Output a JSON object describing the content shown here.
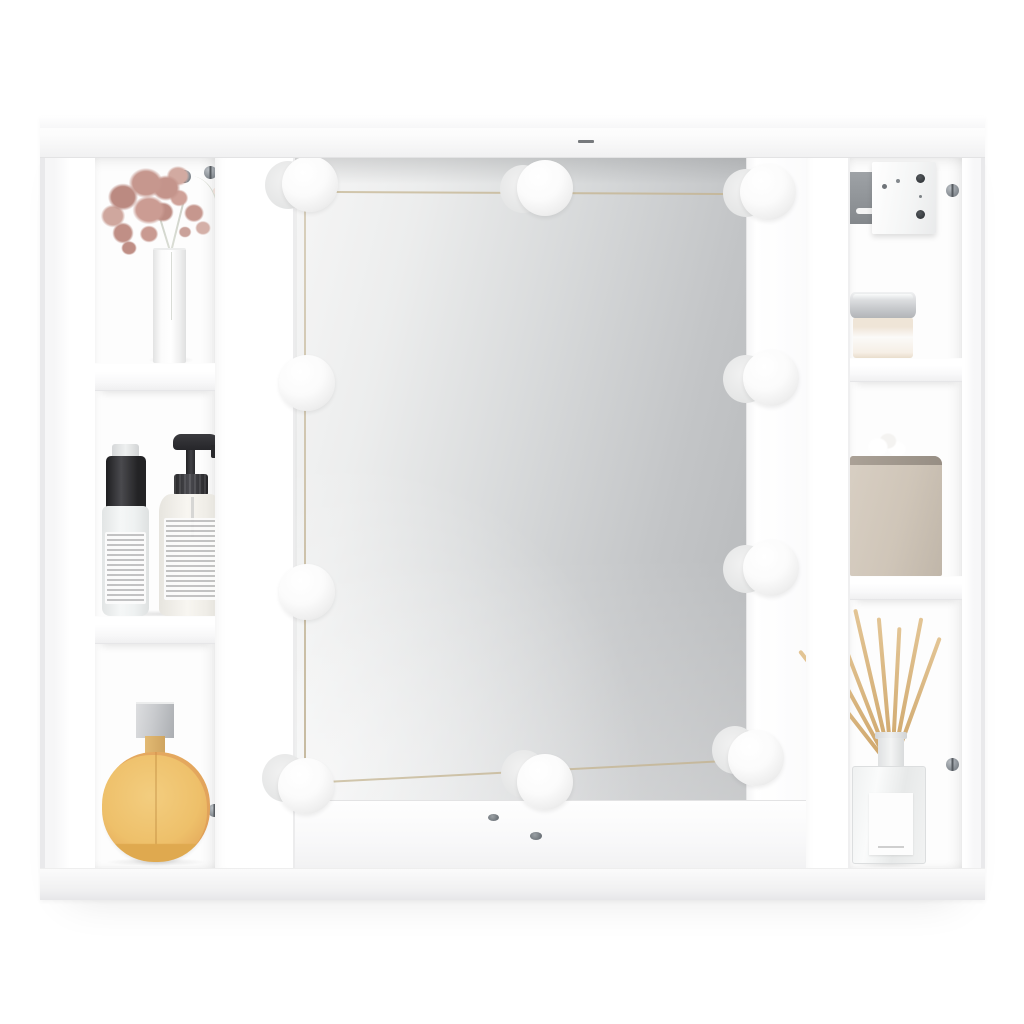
{
  "scene": {
    "type": "product-photo",
    "description": "White wall-mounted LED mirror cabinet with open shelf compartments on both sides, styled with decor items, on a plain white background",
    "background_color": "#ffffff"
  },
  "cabinet": {
    "body_color": "#ffffff",
    "led_bulbs": {
      "count": 10,
      "positions": [
        {
          "x": 270,
          "y": 68,
          "side": "top"
        },
        {
          "x": 505,
          "y": 72,
          "side": "top"
        },
        {
          "x": 728,
          "y": 76,
          "side": "top"
        },
        {
          "x": 731,
          "y": 262,
          "side": "right"
        },
        {
          "x": 731,
          "y": 452,
          "side": "right"
        },
        {
          "x": 716,
          "y": 642,
          "side": "bottom"
        },
        {
          "x": 505,
          "y": 666,
          "side": "bottom"
        },
        {
          "x": 266,
          "y": 670,
          "side": "bottom"
        },
        {
          "x": 267,
          "y": 476,
          "side": "left"
        },
        {
          "x": 267,
          "y": 267,
          "side": "left"
        }
      ]
    },
    "compartments": {
      "left_column": [
        "dried-flower-spray-in-vase",
        "spray-bottle-and-pump-bottle",
        "amber-perfume-bottle"
      ],
      "center": [
        "mirror-with-led-bulb-string"
      ],
      "right_column": [
        "wall-mount-bracket",
        "candle-jar-silver-lid",
        "tissue-box",
        "reed-diffuser"
      ]
    }
  },
  "colors": {
    "background": "#ffffff",
    "edge_shade": "#e9e9eb",
    "mirror_light": "#f6f6f6",
    "mirror_mid": "#d8dadb",
    "mirror_dark": "#b5b7b9",
    "wire": "#d2c7ad",
    "bulb_core": "#ffffff",
    "bulb_edge": "#dedede",
    "flower_main": "#c6978e",
    "flower_dark": "#bb8a81",
    "flower_light": "#cfa79e",
    "vase": "#dfe0e0",
    "black_cap": "#4a4a4e",
    "clear_bottle": "#f5f7f7",
    "cream_bottle": "#f8f6f1",
    "perfume_amber": "#eec06a",
    "perfume_deep": "#dfa94f",
    "perfume_rim": "#d9975f",
    "silver_light": "#c9cbce",
    "gold_neck": "#e2ba74",
    "candle_cream": "#efe5d7",
    "tissue_main": "#cfc5b8",
    "tissue_dark": "#c0b6a9",
    "tissue_edge": "#978e84",
    "reed": "#cda468",
    "glass": "#fafbfb",
    "bracket_metal": "#84888c",
    "screw_dark": "#565b60"
  }
}
